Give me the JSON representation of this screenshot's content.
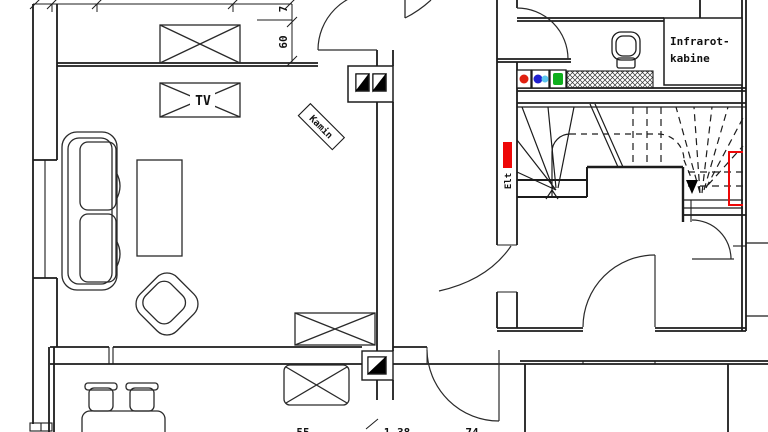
{
  "labels": {
    "tv": "TV",
    "fireplace": "Kamin",
    "electrical": "Elt",
    "sauna_line1": "Infrarot-",
    "sauna_line2": "kabine"
  },
  "dimensions": {
    "niche_top": "7",
    "niche_height": "60",
    "bottom_left": "55",
    "bottom_middle": "1.38",
    "bottom_right": "74"
  },
  "colors": {
    "line": "#1c1c1c",
    "red": "#ee0707",
    "marker_red": "#e02010",
    "blue": "#2020cf",
    "cyan": "#5cc6ef",
    "green": "#0faf1d"
  }
}
